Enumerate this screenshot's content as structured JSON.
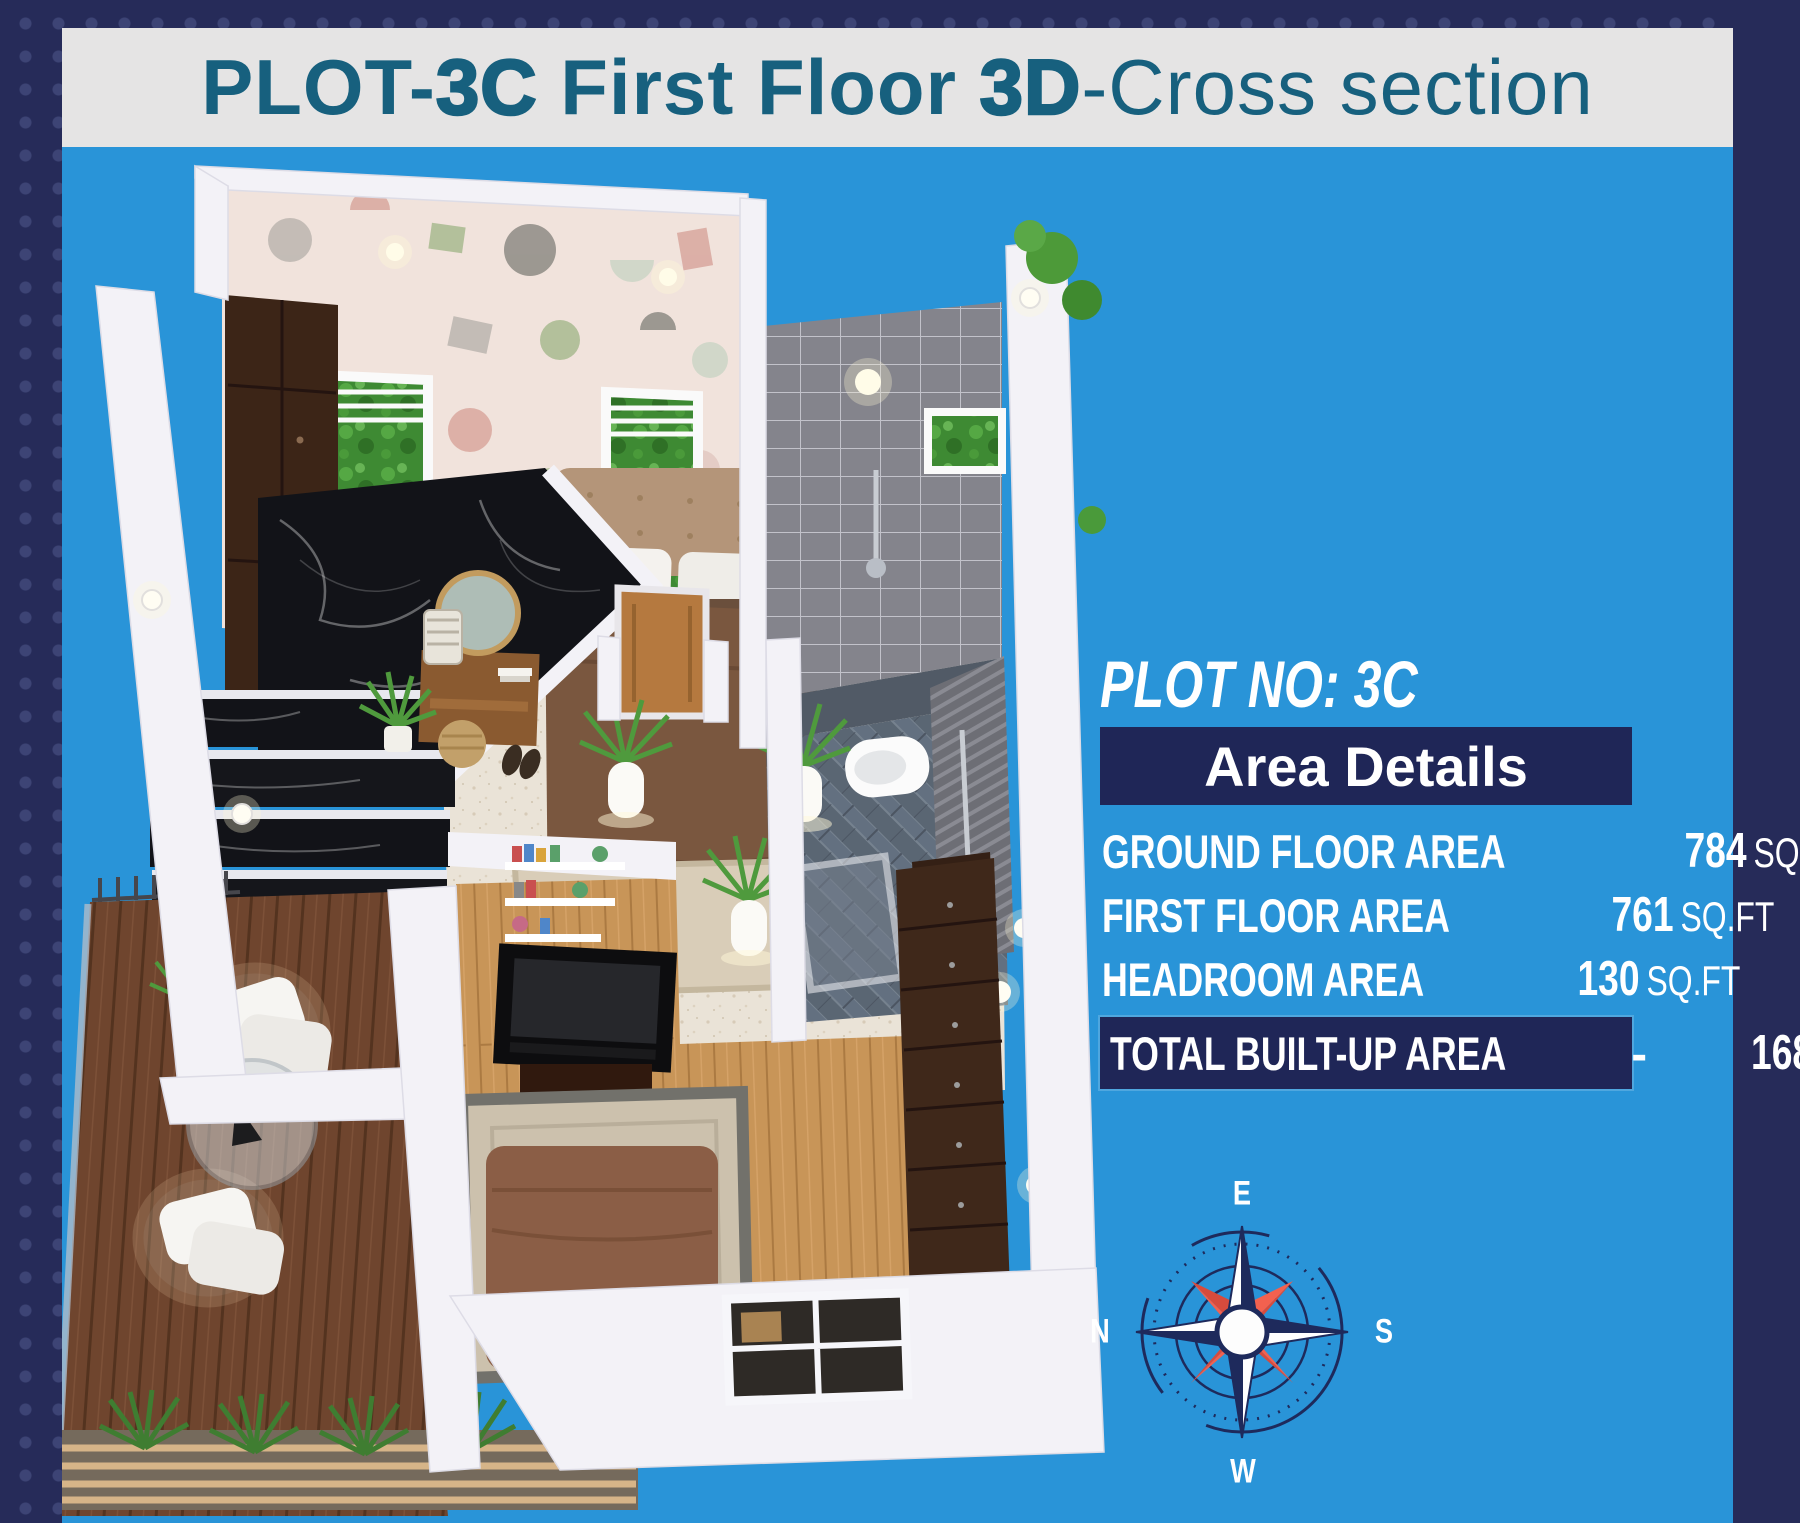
{
  "title": {
    "part1": "PLOT-",
    "part2": "3C",
    "part3": " First Floor ",
    "part4": "3D",
    "part5": "-Cross section"
  },
  "panel": {
    "plot_no": "PLOT NO: 3C",
    "header": "Area Details",
    "rows": [
      {
        "label": "GROUND FLOOR AREA",
        "value": "784",
        "unit": "SQ.FT"
      },
      {
        "label": "FIRST  FLOOR AREA",
        "value": "761",
        "unit": "SQ.FT"
      },
      {
        "label": "HEADROOM AREA",
        "value": "130",
        "unit": "SQ.FT"
      }
    ],
    "total": {
      "label": "TOTAL BUILT-UP AREA",
      "dash": "-",
      "value": "1681",
      "unit": "SQ.FT"
    }
  },
  "compass": {
    "top": "E",
    "right": "S",
    "bottom": "W",
    "left": "N"
  },
  "colors": {
    "background_blue": "#2994d8",
    "frame_navy": "#262b59",
    "banner_gray": "#e5e4e4",
    "title_teal": "#17607e",
    "panel_bar_navy": "#1f2657",
    "compass_red": "#f0594a",
    "compass_navy": "#1e2a5c"
  }
}
